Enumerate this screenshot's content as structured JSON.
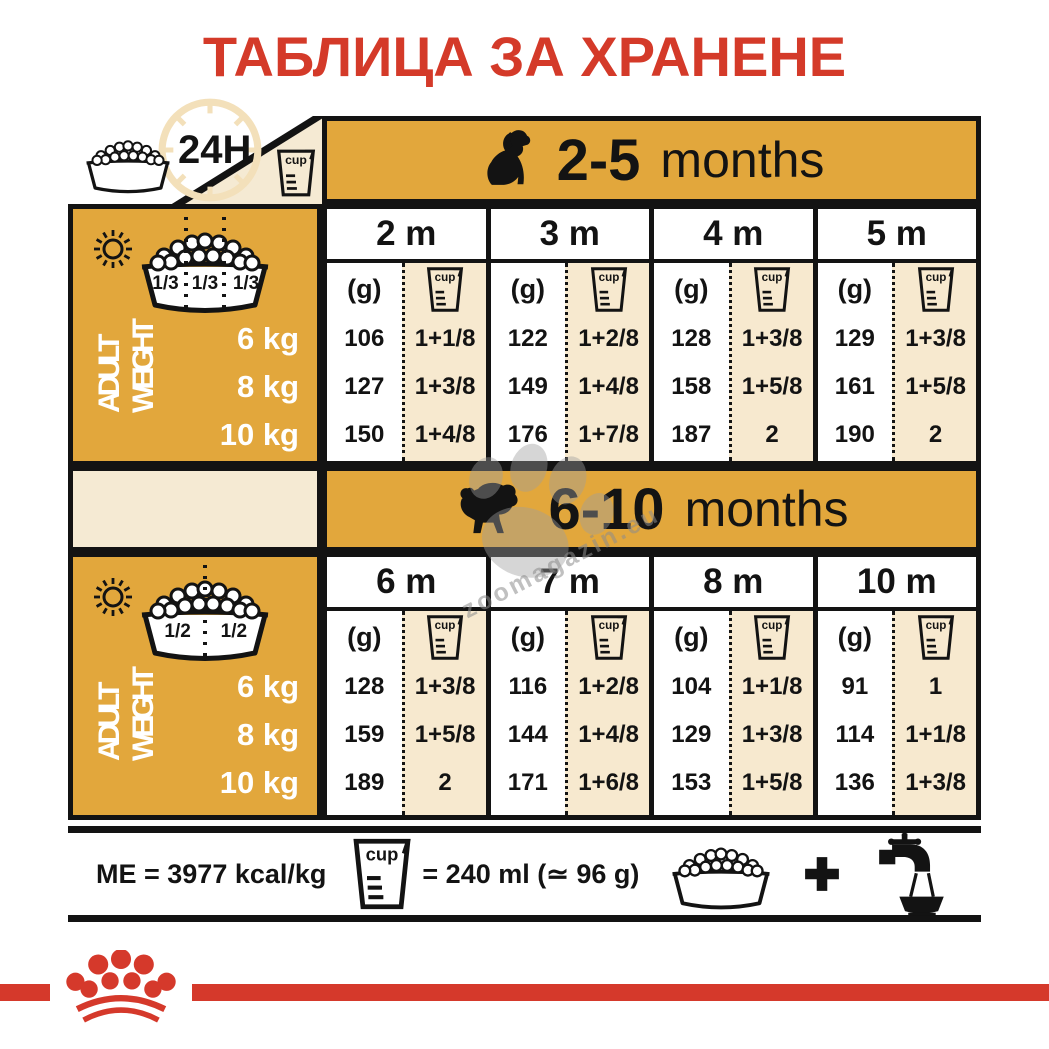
{
  "title": "ТАБЛИЦА ЗА ХРАНЕНЕ",
  "cup_word": "cup",
  "top_left": {
    "hours": "24H"
  },
  "grams_label": "(g)",
  "axis": {
    "word1": "ADULT",
    "word2": "WEIGHT"
  },
  "weights": [
    "6 kg",
    "8 kg",
    "10 kg"
  ],
  "sections": [
    {
      "age_range": "2-5",
      "age_unit": "months",
      "fractions": [
        "1/3",
        "1/3",
        "1/3"
      ],
      "columns": [
        {
          "month": "2 m",
          "g": [
            "106",
            "127",
            "150"
          ],
          "cups": [
            "1+1/8",
            "1+3/8",
            "1+4/8"
          ]
        },
        {
          "month": "3 m",
          "g": [
            "122",
            "149",
            "176"
          ],
          "cups": [
            "1+2/8",
            "1+4/8",
            "1+7/8"
          ]
        },
        {
          "month": "4 m",
          "g": [
            "128",
            "158",
            "187"
          ],
          "cups": [
            "1+3/8",
            "1+5/8",
            "2"
          ]
        },
        {
          "month": "5 m",
          "g": [
            "129",
            "161",
            "190"
          ],
          "cups": [
            "1+3/8",
            "1+5/8",
            "2"
          ]
        }
      ]
    },
    {
      "age_range": "6-10",
      "age_unit": "months",
      "fractions": [
        "1/2",
        "1/2"
      ],
      "columns": [
        {
          "month": "6 m",
          "g": [
            "128",
            "159",
            "189"
          ],
          "cups": [
            "1+3/8",
            "1+5/8",
            "2"
          ]
        },
        {
          "month": "7 m",
          "g": [
            "116",
            "144",
            "171"
          ],
          "cups": [
            "1+2/8",
            "1+4/8",
            "1+6/8"
          ]
        },
        {
          "month": "8 m",
          "g": [
            "104",
            "129",
            "153"
          ],
          "cups": [
            "1+1/8",
            "1+3/8",
            "1+5/8"
          ]
        },
        {
          "month": "10 m",
          "g": [
            "91",
            "114",
            "136"
          ],
          "cups": [
            "1",
            "1+1/8",
            "1+3/8"
          ]
        }
      ]
    }
  ],
  "footer": {
    "me": "ME = 3977 kcal/kg",
    "equiv": "= 240 ml (≃ 96 g)"
  },
  "watermark": "zoomagazin.eu",
  "colors": {
    "gold": "#E2A73C",
    "cream": "#F7E9CF",
    "red": "#D5392B",
    "black": "#131313"
  },
  "chart_data": [
    {
      "type": "table",
      "title": "2-5 months",
      "row_header": "ADULT WEIGHT",
      "rows": [
        "6 kg",
        "8 kg",
        "10 kg"
      ],
      "columns": [
        "2 m (g)",
        "2 m (cup)",
        "3 m (g)",
        "3 m (cup)",
        "4 m (g)",
        "4 m (cup)",
        "5 m (g)",
        "5 m (cup)"
      ],
      "values": [
        [
          106,
          "1+1/8",
          122,
          "1+2/8",
          128,
          "1+3/8",
          129,
          "1+3/8"
        ],
        [
          127,
          "1+3/8",
          149,
          "1+4/8",
          158,
          "1+5/8",
          161,
          "1+5/8"
        ],
        [
          150,
          "1+4/8",
          176,
          "1+7/8",
          187,
          "2",
          190,
          "2"
        ]
      ],
      "notes": [
        "3 meals per day (1/3 + 1/3 + 1/3)",
        "ME = 3977 kcal/kg",
        "cup = 240 ml (≈ 96 g)"
      ]
    },
    {
      "type": "table",
      "title": "6-10 months",
      "row_header": "ADULT WEIGHT",
      "rows": [
        "6 kg",
        "8 kg",
        "10 kg"
      ],
      "columns": [
        "6 m (g)",
        "6 m (cup)",
        "7 m (g)",
        "7 m (cup)",
        "8 m (g)",
        "8 m (cup)",
        "10 m (g)",
        "10 m (cup)"
      ],
      "values": [
        [
          128,
          "1+3/8",
          116,
          "1+2/8",
          104,
          "1+1/8",
          91,
          "1"
        ],
        [
          159,
          "1+5/8",
          144,
          "1+4/8",
          129,
          "1+3/8",
          114,
          "1+1/8"
        ],
        [
          189,
          "2",
          171,
          "1+6/8",
          153,
          "1+5/8",
          136,
          "1+3/8"
        ]
      ],
      "notes": [
        "2 meals per day (1/2 + 1/2)"
      ]
    }
  ]
}
